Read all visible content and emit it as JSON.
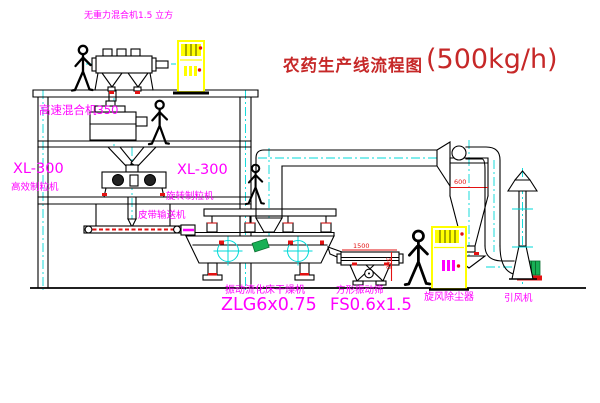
{
  "title": {
    "text": "农药生产线流程图",
    "capacity": "(500kg/h)"
  },
  "equipment_labels": {
    "gravity_free_mixer": "无重力混合机1.5 立方",
    "high_speed_mixer": "高速混合机350",
    "granulator_upper_model": "XL-300",
    "granulator_upper_name": "高效制粒机",
    "granulator_lower_model": "XL-300",
    "granulator_lower_name": "旋转制粒机",
    "belt_conveyor": "皮带输送机",
    "fluid_bed_dryer_name": "振动流化床干燥机",
    "fluid_bed_dryer_model": "ZLG6x0.75",
    "square_sieve_name": "方形振动筛",
    "square_sieve_model": "FS0.6x1.5",
    "cyclone": "旋风除尘器",
    "induced_draft_fan": "引风机"
  },
  "dimensions": {
    "cyclone_dia": "600",
    "sieve_length": "1500",
    "sieve_height": "340"
  },
  "colors": {
    "label_magenta": "#ff00ff",
    "title_red": "#c62828",
    "centerline_cyan": "#00d8d8",
    "equipment_yellow": "#ffff00",
    "accent_red": "#e31212",
    "motor_green": "#18b055",
    "line_black": "#000000"
  }
}
